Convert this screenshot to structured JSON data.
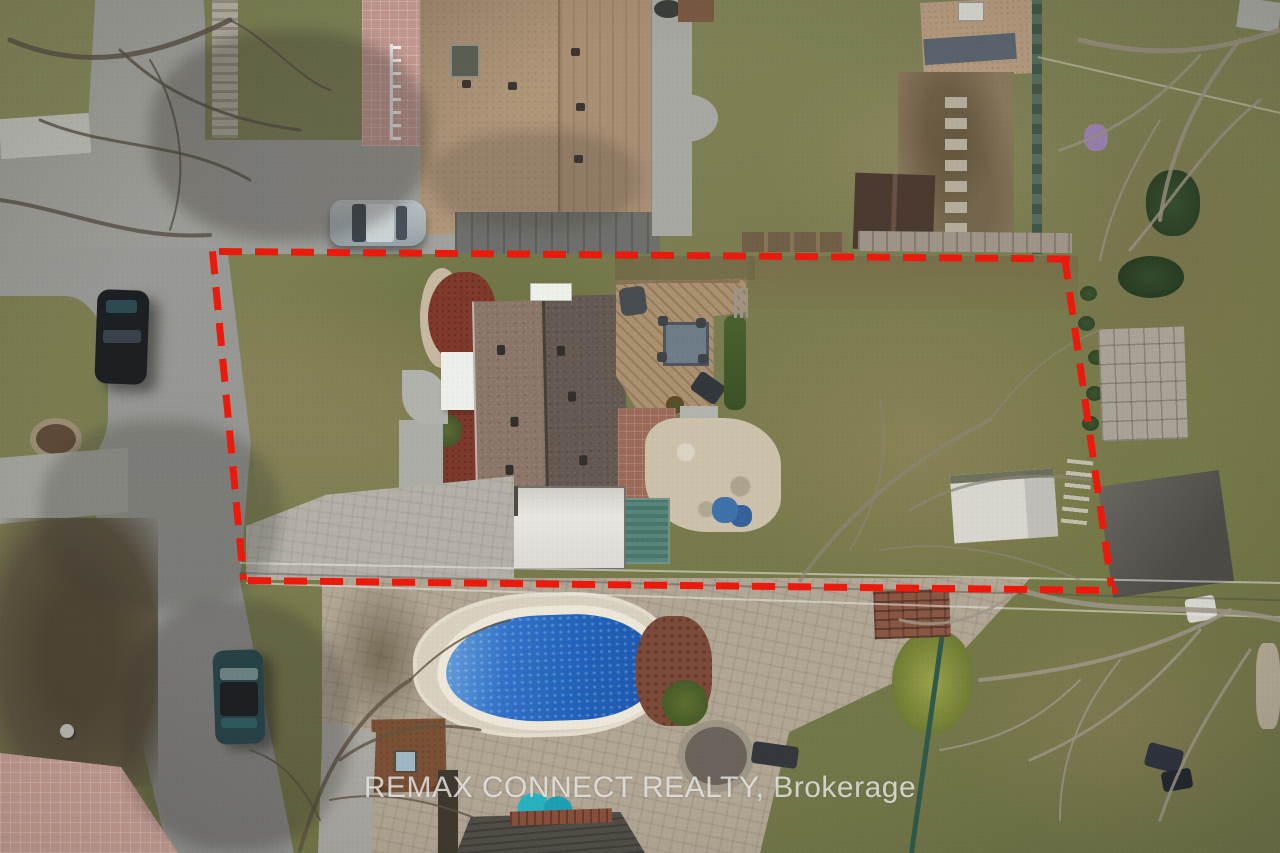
{
  "watermark": {
    "text": "REMAX CONNECT REALTY, Brokerage"
  },
  "overlay": {
    "boundary_color": "#ec1a0c"
  },
  "palette": {
    "pool_water": "#2a6ac3",
    "pool_coping": "#ece7d9",
    "grass": "#7a7d52",
    "road": "#9c9c98",
    "neighbor_roof": "#b1977a",
    "subject_roof_light": "#8b7669",
    "subject_roof_dark": "#645a51",
    "deck_wood": "#ab9170",
    "red_mulch": "#813a2c",
    "paver_patio": "#b2a795"
  }
}
